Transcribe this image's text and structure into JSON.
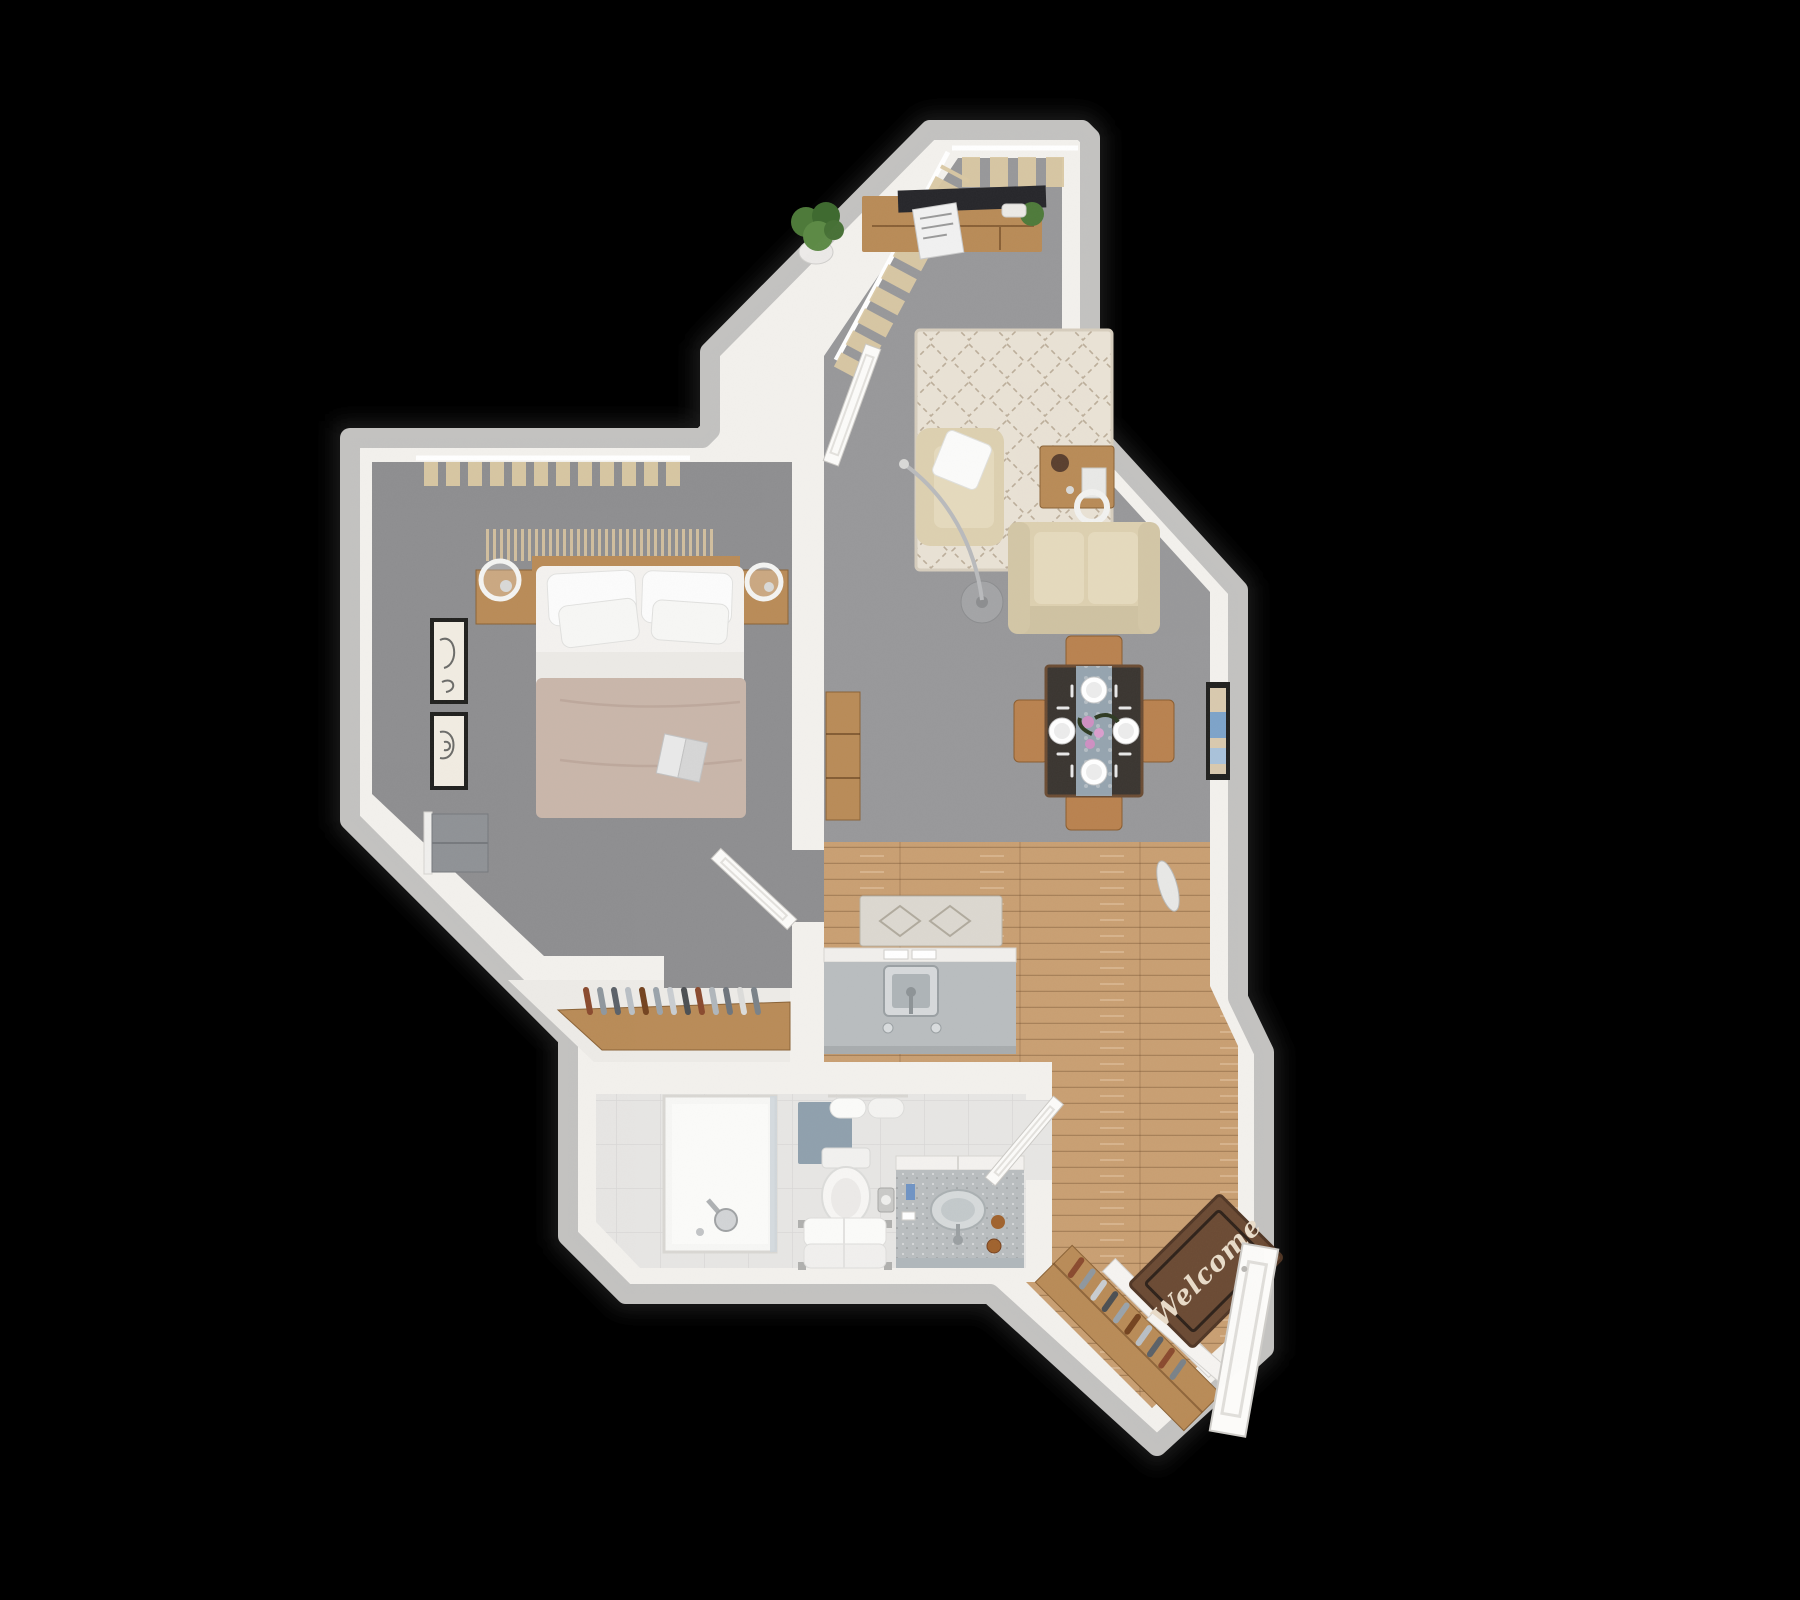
{
  "meta": {
    "title": "3D floor plan render — one-bedroom apartment, top-down view",
    "canvas": {
      "width": 1800,
      "height": 1600
    },
    "background": "#000000"
  },
  "palette": {
    "wall": "#f3f1ed",
    "wall_outer": "#c3c2c0",
    "carpet": "#98989a",
    "carpet_bedroom": "#8e8e90",
    "wood": "#c99f72",
    "wood_dark": "#b98b57",
    "tile": "#e7e6e4",
    "nook_floor": "#edebe7",
    "rug_cream": "#e9e2d5",
    "curtain_beige": "#dbc9a4",
    "sofa_beige": "#ddd0b0",
    "cushion_beige": "#e5dabd",
    "table_dark": "#3a3530",
    "chair_wood": "#b9824f",
    "runner_blue": "#9fb0bd",
    "blanket_taupe": "#c9b6aa",
    "counter_gray": "#b9bdbf",
    "mat_blue": "#8fa0ad",
    "doormat_brown": "#6b4a33",
    "doormat_text_color": "#e9dcc9",
    "plant_green": "#4e7a3a",
    "accent_pink": "#cf8fc2",
    "door_white": "#fcfbf9",
    "frame_black": "#20201e"
  },
  "rooms": [
    {
      "id": "living-room",
      "floor": "gray-carpet",
      "furniture": [
        "window-curtains",
        "media-console",
        "tv",
        "magazine-stack",
        "decor-bowl",
        "potted-plant",
        "area-rug",
        "armchair",
        "throw-pillow",
        "coffee-table",
        "c-side-table",
        "sofa",
        "arc-floor-lamp",
        "console-shelf",
        "open-hallway-door"
      ]
    },
    {
      "id": "dining-area",
      "floor": "gray-carpet",
      "furniture": [
        "dining-table",
        "table-runner",
        "place-settings-x4",
        "flower-centerpiece",
        "wood-chairs-x4",
        "wall-art",
        "oval-decor"
      ]
    },
    {
      "id": "kitchen-hallway",
      "floor": "oak-plank",
      "furniture": [
        "island-counter",
        "sink",
        "faucet-handles",
        "kitchen-mat"
      ]
    },
    {
      "id": "bedroom",
      "floor": "gray-carpet",
      "furniture": [
        "window-curtains",
        "macrame-hanging",
        "double-bed",
        "pillows-x4",
        "taupe-blanket",
        "open-book",
        "nightstand-left",
        "nightstand-right",
        "pendant-ring-lamp-left",
        "pendant-ring-lamp-right",
        "wall-frame-upper",
        "wall-frame-lower",
        "gray-dresser",
        "bedroom-door"
      ]
    },
    {
      "id": "closet-nook",
      "floor": "white",
      "furniture": [
        "wardrobe-rail",
        "hanging-clothes"
      ]
    },
    {
      "id": "bathroom",
      "floor": "light-tile",
      "furniture": [
        "walk-in-shower",
        "shower-column",
        "blue-bath-mat",
        "rolled-towels",
        "toilet",
        "toilet-paper-holder",
        "towel-bench",
        "vanity-counter",
        "round-basin",
        "faucet",
        "toiletries",
        "bathroom-door"
      ]
    },
    {
      "id": "entry",
      "floor": "oak-plank",
      "furniture": [
        "welcome-doormat",
        "front-door",
        "entry-closet",
        "hanging-clothes",
        "closet-doors"
      ]
    }
  ],
  "entry": {
    "doormat_text": "Welcome"
  }
}
